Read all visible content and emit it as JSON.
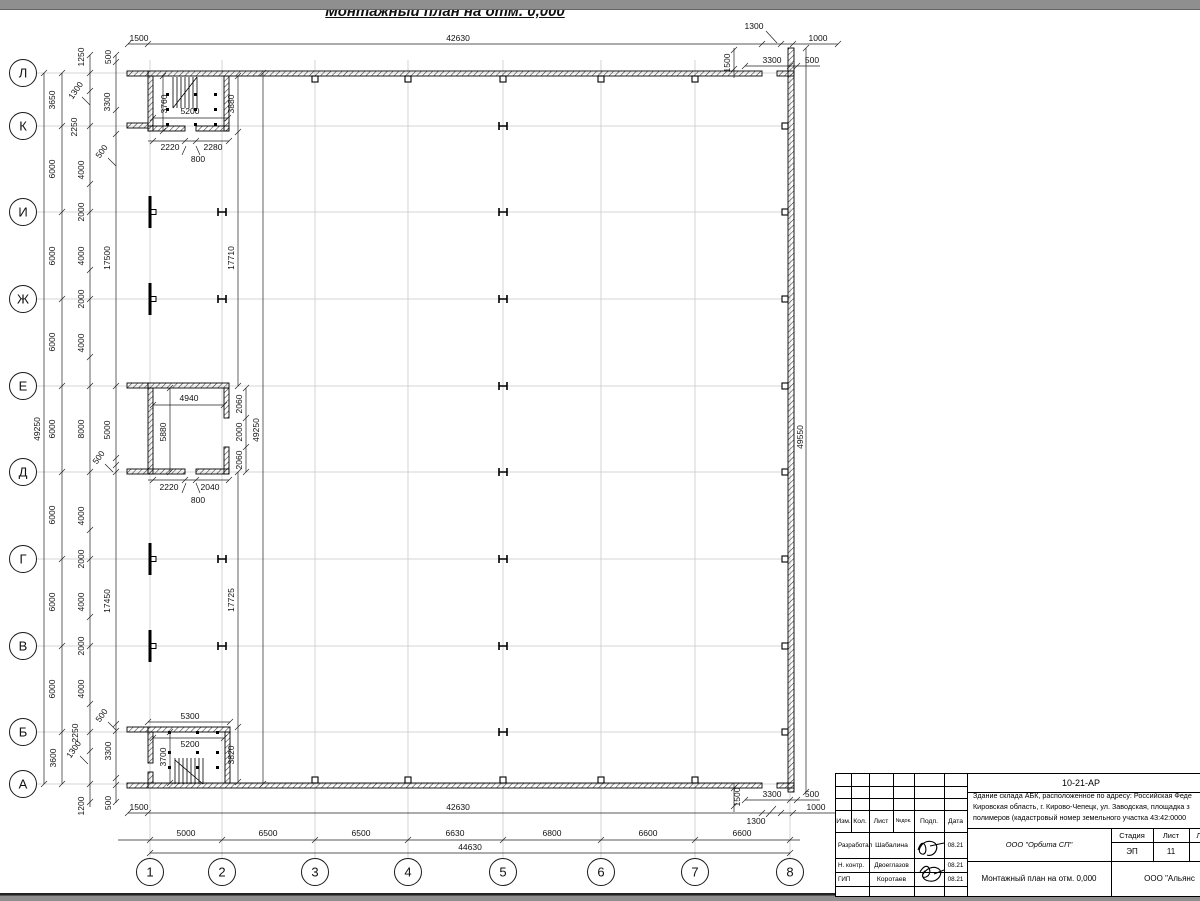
{
  "sheet": {
    "title": "Монтажный план на отм. 0,000"
  },
  "colors": {
    "line": "#1a1a1a",
    "grid": "#c9c9c9",
    "paper": "#ffffff",
    "chrome": "#8f8f8f"
  },
  "plan": {
    "axes": {
      "rows": [
        {
          "label": "Л",
          "y": 73
        },
        {
          "label": "К",
          "y": 126
        },
        {
          "label": "И",
          "y": 212
        },
        {
          "label": "Ж",
          "y": 299
        },
        {
          "label": "Е",
          "y": 386
        },
        {
          "label": "Д",
          "y": 472
        },
        {
          "label": "Г",
          "y": 559
        },
        {
          "label": "В",
          "y": 646
        },
        {
          "label": "Б",
          "y": 732
        },
        {
          "label": "А",
          "y": 784
        }
      ],
      "cols": [
        {
          "label": "1",
          "x": 150
        },
        {
          "label": "2",
          "x": 222
        },
        {
          "label": "3",
          "x": 315
        },
        {
          "label": "4",
          "x": 408
        },
        {
          "label": "5",
          "x": 503
        },
        {
          "label": "6",
          "x": 601
        },
        {
          "label": "7",
          "x": 695
        },
        {
          "label": "8",
          "x": 790
        }
      ]
    },
    "annotations": [
      [
        "1500",
        139,
        41,
        0
      ],
      [
        "42630",
        458,
        41,
        0
      ],
      [
        "1300",
        754,
        29,
        0
      ],
      [
        "1000",
        818,
        41,
        0
      ],
      [
        "1500",
        730,
        63,
        1
      ],
      [
        "3300",
        772,
        63,
        0
      ],
      [
        "500",
        812,
        63,
        0
      ],
      [
        "49550",
        803,
        437,
        1
      ],
      [
        "1500",
        740,
        797,
        1
      ],
      [
        "3300",
        772,
        797,
        0
      ],
      [
        "500",
        812,
        797,
        0
      ],
      [
        "1000",
        816,
        810,
        0
      ],
      [
        "1300",
        756,
        824,
        0
      ],
      [
        "1500",
        139,
        810,
        0
      ],
      [
        "42630",
        458,
        810,
        0
      ],
      [
        "5000",
        186,
        836,
        0
      ],
      [
        "6500",
        268,
        836,
        0
      ],
      [
        "6500",
        361,
        836,
        0
      ],
      [
        "6630",
        455,
        836,
        0
      ],
      [
        "6800",
        552,
        836,
        0
      ],
      [
        "6600",
        648,
        836,
        0
      ],
      [
        "6600",
        742,
        836,
        0
      ],
      [
        "44630",
        470,
        850,
        0
      ],
      [
        "49250",
        40,
        429,
        1
      ],
      [
        "3650",
        55,
        100,
        1
      ],
      [
        "6000",
        55,
        169,
        1
      ],
      [
        "6000",
        55,
        256,
        1
      ],
      [
        "6000",
        55,
        342,
        1
      ],
      [
        "6000",
        55,
        429,
        1
      ],
      [
        "6000",
        55,
        515,
        1
      ],
      [
        "6000",
        55,
        602,
        1
      ],
      [
        "6000",
        55,
        689,
        1
      ],
      [
        "3600",
        56,
        758,
        1
      ],
      [
        "1250",
        84,
        57,
        1
      ],
      [
        "1300",
        78,
        92,
        2
      ],
      [
        "2250",
        77,
        127,
        1
      ],
      [
        "4000",
        84,
        170,
        1
      ],
      [
        "2000",
        84,
        212,
        1
      ],
      [
        "4000",
        84,
        256,
        1
      ],
      [
        "2000",
        84,
        299,
        1
      ],
      [
        "4000",
        84,
        343,
        1
      ],
      [
        "8000",
        84,
        429,
        1
      ],
      [
        "4000",
        84,
        516,
        1
      ],
      [
        "2000",
        84,
        559,
        1
      ],
      [
        "4000",
        84,
        602,
        1
      ],
      [
        "2000",
        84,
        646,
        1
      ],
      [
        "4000",
        84,
        689,
        1
      ],
      [
        "2250",
        78,
        733,
        1
      ],
      [
        "1300",
        76,
        751,
        2
      ],
      [
        "1200",
        84,
        806,
        1
      ],
      [
        "500",
        111,
        57,
        1
      ],
      [
        "3300",
        110,
        102,
        1
      ],
      [
        "500",
        104,
        153,
        2
      ],
      [
        "17500",
        110,
        258,
        1
      ],
      [
        "5000",
        110,
        430,
        1
      ],
      [
        "500",
        101,
        459,
        2
      ],
      [
        "17450",
        110,
        601,
        1
      ],
      [
        "500",
        104,
        717,
        2
      ],
      [
        "3300",
        111,
        751,
        1
      ],
      [
        "500",
        111,
        803,
        1
      ],
      [
        "3760",
        167,
        104,
        1
      ],
      [
        "5200",
        190,
        114,
        0
      ],
      [
        "3880",
        234,
        104,
        1
      ],
      [
        "2220",
        170,
        150,
        0
      ],
      [
        "2280",
        213,
        150,
        0
      ],
      [
        "800",
        198,
        162,
        0
      ],
      [
        "17710",
        234,
        258,
        1
      ],
      [
        "49250",
        259,
        430,
        1
      ],
      [
        "17725",
        234,
        600,
        1
      ],
      [
        "3820",
        234,
        755,
        1
      ],
      [
        "4940",
        189,
        401,
        0
      ],
      [
        "2060",
        242,
        404,
        1
      ],
      [
        "2000",
        242,
        432,
        1
      ],
      [
        "2060",
        242,
        460,
        1
      ],
      [
        "5880",
        166,
        432,
        1
      ],
      [
        "2220",
        169,
        490,
        0
      ],
      [
        "2040",
        210,
        490,
        0
      ],
      [
        "800",
        198,
        503,
        0
      ],
      [
        "5300",
        190,
        719,
        0
      ],
      [
        "5200",
        190,
        747,
        0
      ],
      [
        "3700",
        166,
        757,
        1
      ]
    ]
  },
  "title_block": {
    "doc_number": "10-21-АР",
    "desc": [
      "Здание склада АБК, расположенное по адресу: Российская Феде",
      "Кировская область, г. Кирово-Чепецк, ул. Заводская, площадка з",
      "полимеров (кадастровый номер земельного участка 43:42:0000"
    ],
    "header_cols": [
      "Изм.",
      "Кол.",
      "Лист",
      "№док.",
      "Подп.",
      "Дата"
    ],
    "rows": [
      {
        "role": "Разработал",
        "name": "Шабалина",
        "date": "08.21"
      },
      {
        "role": "Н. контр.",
        "name": "Двоеглазов",
        "date": "08.21"
      },
      {
        "role": "ГИП",
        "name": "Коротаев",
        "date": "08.21"
      }
    ],
    "company": "ООО \"Орбита СП\"",
    "stage_header": [
      "Стадия",
      "Лист",
      "Листов"
    ],
    "stage_values": [
      "ЭП",
      "11",
      "1"
    ],
    "drawing_title": "Монтажный план на отм. 0,000",
    "contractor": "ООО \"Альянс"
  }
}
